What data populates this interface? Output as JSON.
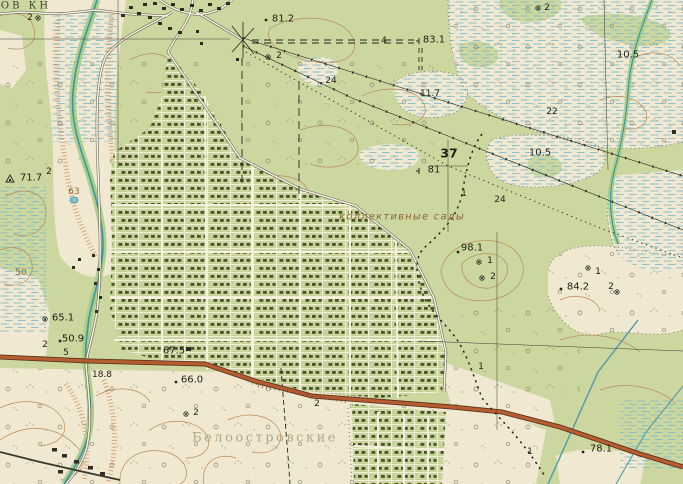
{
  "map_type": "soviet-topographic-map",
  "place_names": {
    "collective_gardens": "коллективные сады",
    "bog_name": "Белоостровские",
    "corner_partial_name": "ОВ КН"
  },
  "labels": [
    {
      "text": "ОВ КН",
      "kind": "partial-place-name"
    },
    {
      "text": "2",
      "kind": "feature-number"
    },
    {
      "text": "81.2",
      "kind": "spot-height"
    },
    {
      "text": "4",
      "kind": "winter-road-number"
    },
    {
      "text": "83.1",
      "kind": "benchmark-height"
    },
    {
      "text": "2",
      "kind": "feature-number"
    },
    {
      "text": "24",
      "kind": "line-label"
    },
    {
      "text": "11.7",
      "kind": "marsh-depth"
    },
    {
      "text": "10.5",
      "kind": "marsh-depth"
    },
    {
      "text": "2",
      "kind": "feature-number"
    },
    {
      "text": "22",
      "kind": "line-label"
    },
    {
      "text": "10.5",
      "kind": "marsh-depth"
    },
    {
      "text": "37",
      "kind": "quarter-post-number"
    },
    {
      "text": "81",
      "kind": "benchmark-height"
    },
    {
      "text": "24",
      "kind": "line-label"
    },
    {
      "text": "1",
      "kind": "feature-number"
    },
    {
      "text": "коллективные сады",
      "kind": "area-name"
    },
    {
      "text": "98.1",
      "kind": "spot-height"
    },
    {
      "text": "1",
      "kind": "feature-number"
    },
    {
      "text": "2",
      "kind": "feature-number"
    },
    {
      "text": "84.2",
      "kind": "spot-height"
    },
    {
      "text": "1",
      "kind": "feature-number"
    },
    {
      "text": "2",
      "kind": "feature-number"
    },
    {
      "text": "71.7",
      "kind": "triangulation-height"
    },
    {
      "text": "2",
      "kind": "feature-number"
    },
    {
      "text": "63",
      "kind": "contour-label"
    },
    {
      "text": "50",
      "kind": "contour-label"
    },
    {
      "text": "65.1",
      "kind": "spot-height"
    },
    {
      "text": "50.9",
      "kind": "spot-height"
    },
    {
      "text": "5",
      "kind": "feature-number"
    },
    {
      "text": "2",
      "kind": "feature-number"
    },
    {
      "text": "67.5",
      "kind": "spot-height"
    },
    {
      "text": "66.0",
      "kind": "spot-height"
    },
    {
      "text": "18.8",
      "kind": "spot-height"
    },
    {
      "text": "2",
      "kind": "feature-number"
    },
    {
      "text": "Белоостровские",
      "kind": "bog-name"
    },
    {
      "text": "78.1",
      "kind": "spot-height"
    },
    {
      "text": "1",
      "kind": "feature-number"
    },
    {
      "text": "1",
      "kind": "feature-number"
    },
    {
      "text": "2",
      "kind": "feature-number"
    }
  ],
  "colors": {
    "open_ground": "#f0e8d1",
    "forest_green": "#ccd7a0",
    "garden_green": "#c7d49a",
    "plot_building": "#4a5230",
    "marsh_blue": "#74b9cc",
    "contour_brown": "#b98a58",
    "scarp_orange": "#c8763c",
    "water": "#3d95a8",
    "water_vegetation": "#a4cd83",
    "highway_fill": "#b55c31",
    "highway_casing": "#5f351d",
    "road_white": "#f6f0dd",
    "ink": "#26261d",
    "label_brown": "#8d6c3c",
    "bog_text": "#a8a183"
  }
}
